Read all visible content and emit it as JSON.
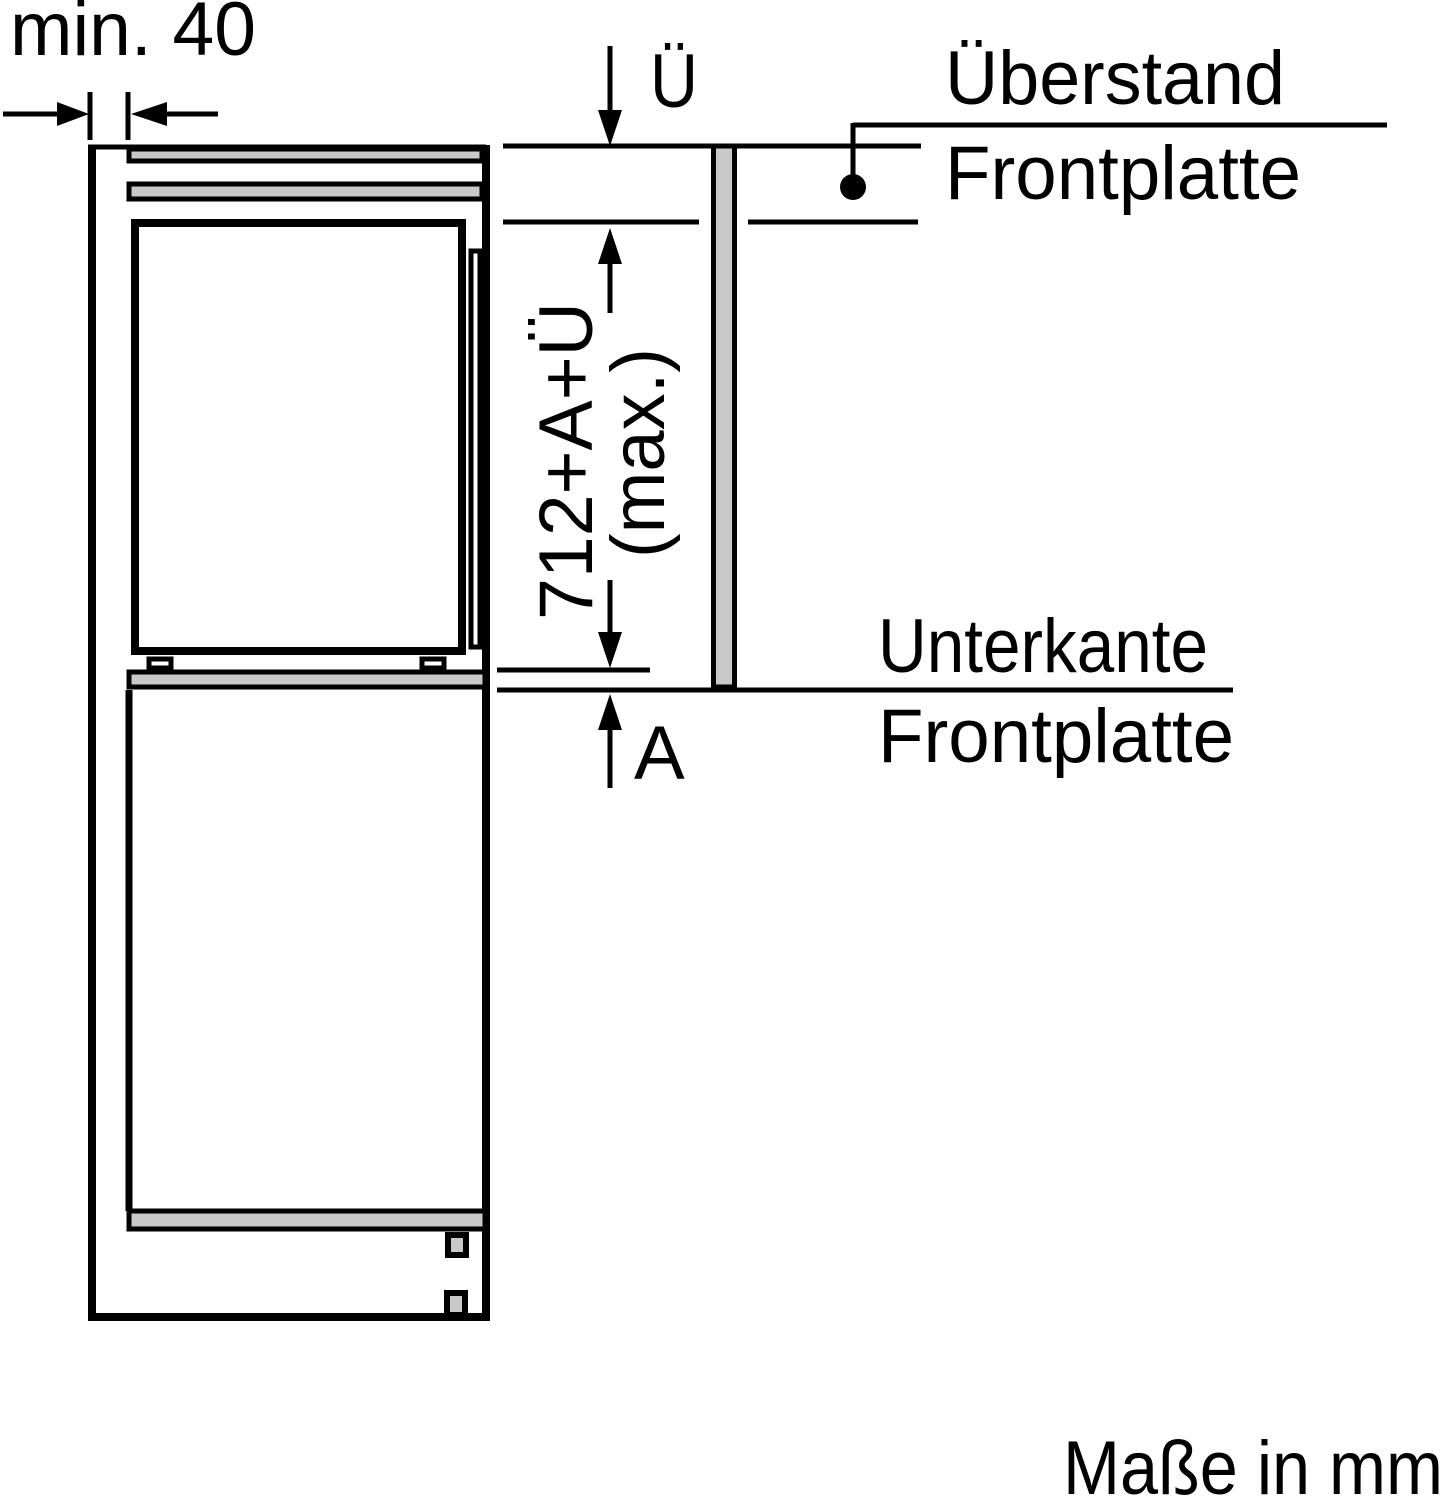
{
  "diagram": {
    "kind": "appliance-installation-dimension-drawing",
    "labels": {
      "min_gap": "min. 40",
      "overhang_symbol": "Ü",
      "overhang_name_line1": "Überstand",
      "overhang_name_line2": "Frontplatte",
      "height_formula_line1": "712+A+Ü",
      "height_formula_line2": "(max.)",
      "gap_symbol": "A",
      "bottom_edge_line1": "Unterkante",
      "bottom_edge_line2": "Frontplatte",
      "units_note": "Maße in mm"
    },
    "dimensions_shown": {
      "side_clearance_min_mm": "min. 40",
      "front_panel_height_max": "712+A+Ü (max.)",
      "overhang_variable": "Ü",
      "bottom_gap_variable": "A",
      "units": "mm"
    },
    "colors": {
      "line": "#000000",
      "panel_fill": "#c9c9c9",
      "background": "#ffffff"
    }
  }
}
